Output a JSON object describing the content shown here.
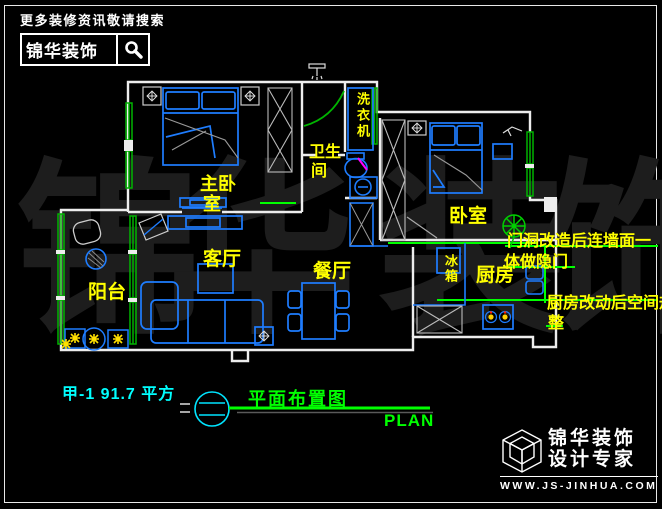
{
  "header": {
    "slogan": "更多装修资讯敬请搜索",
    "brand": "锦华装饰",
    "search_icon": "magnifier-icon"
  },
  "watermark": {
    "chars": [
      "锦",
      "华",
      "装",
      "饰"
    ]
  },
  "plan": {
    "room_labels": {
      "master_bedroom_line1": "主卧",
      "master_bedroom_line2": "室",
      "bathroom_line1": "卫生",
      "bathroom_line2": "间",
      "washing_machine": "洗衣机",
      "bedroom": "卧室",
      "living_room": "客厅",
      "dining_room": "餐厅",
      "kitchen": "厨房",
      "balcony": "阳台",
      "fridge": "冰箱"
    },
    "annotations": {
      "hidden_door_line1": "门洞改造后连墙面一",
      "hidden_door_line2": "体做隐门",
      "kitchen_change_line1": "厨房改动后空间规",
      "kitchen_change_line2": "整"
    }
  },
  "footer": {
    "unit_area": "甲-1  91.7 平方",
    "drawing_title": "平面布置图",
    "drawing_title_en": "PLAN"
  },
  "logo": {
    "brand": "锦华装饰",
    "tagline": "设计专家",
    "website": "WWW.JS-JINHUA.COM"
  },
  "colors": {
    "background": "#000000",
    "walls": "#ededed",
    "furniture_blue": "#1e7dff",
    "window_green": "#00b400",
    "modified_green": "#00ff00",
    "label_yellow": "#ffff00",
    "area_cyan": "#00ffff",
    "magenta_accent": "#ff00ff",
    "watermark_gray": "#1d1d1d"
  }
}
